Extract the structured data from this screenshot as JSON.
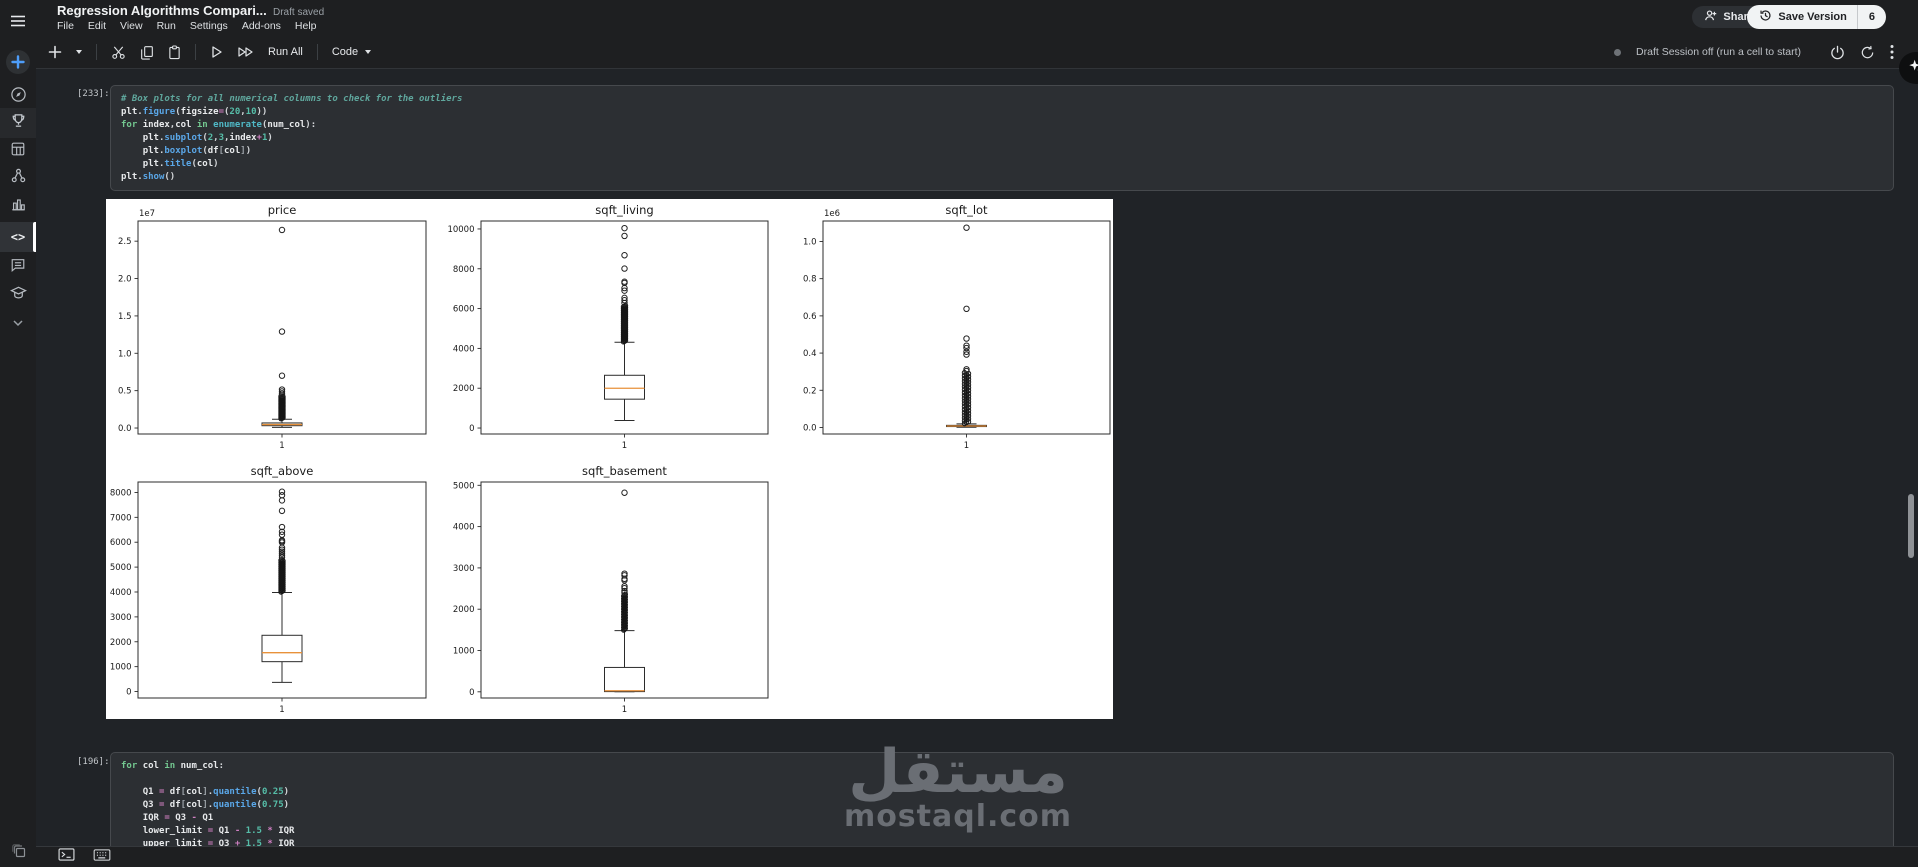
{
  "header": {
    "title": "Regression Algorithms Compari...",
    "draft_status": "Draft saved",
    "menus": [
      "File",
      "Edit",
      "View",
      "Run",
      "Settings",
      "Add-ons",
      "Help"
    ],
    "share_label": "Share",
    "save_version_label": "Save Version",
    "version_count": "6"
  },
  "toolbar": {
    "run_all_label": "Run All",
    "cell_type_label": "Code",
    "session_status": "Draft Session off (run a cell to start)",
    "icons": [
      "add-cell-plus",
      "add-cell-caret-down",
      "cut-scissors",
      "copy-cells",
      "paste-cells",
      "run-cell-play",
      "run-all-fast-forward",
      "power-session",
      "restart-session",
      "more-kebab"
    ]
  },
  "sidebar": {
    "icons": [
      "hamburger-menu",
      "create-plus",
      "home-compass",
      "competitions-trophy",
      "datasets-grid",
      "models-network",
      "benchmarks-chart",
      "code-brackets",
      "discussions-comment",
      "learn-graduation-cap",
      "more-chevron-down"
    ],
    "active": "code-brackets"
  },
  "cells": [
    {
      "exec_label": "[233]:",
      "lines": [
        [
          [
            "# Box plots for all numerical columns to check for the outliers",
            "com"
          ]
        ],
        [
          [
            "plt",
            "id"
          ],
          [
            ".",
            "pun"
          ],
          [
            "figure",
            "fn"
          ],
          [
            "(",
            "pun"
          ],
          [
            "figsize",
            "id"
          ],
          [
            "=",
            "op"
          ],
          [
            "(",
            "pun"
          ],
          [
            "20",
            "num"
          ],
          [
            ",",
            "pun"
          ],
          [
            "10",
            "num"
          ],
          [
            "))",
            "pun"
          ]
        ],
        [
          [
            "for",
            "kw"
          ],
          [
            " ",
            "pun"
          ],
          [
            "index",
            "id"
          ],
          [
            ",",
            "pun"
          ],
          [
            "col",
            "id"
          ],
          [
            " ",
            "pun"
          ],
          [
            "in",
            "kw"
          ],
          [
            " ",
            "pun"
          ],
          [
            "enumerate",
            "bi"
          ],
          [
            "(",
            "pun"
          ],
          [
            "num_col",
            "id"
          ],
          [
            "):",
            "pun"
          ]
        ],
        [
          [
            "    ",
            "pun"
          ],
          [
            "plt",
            "id"
          ],
          [
            ".",
            "pun"
          ],
          [
            "subplot",
            "fn"
          ],
          [
            "(",
            "pun"
          ],
          [
            "2",
            "num"
          ],
          [
            ",",
            "pun"
          ],
          [
            "3",
            "num"
          ],
          [
            ",",
            "pun"
          ],
          [
            "index",
            "id"
          ],
          [
            "+",
            "op"
          ],
          [
            "1",
            "num"
          ],
          [
            ")",
            "pun"
          ]
        ],
        [
          [
            "    ",
            "pun"
          ],
          [
            "plt",
            "id"
          ],
          [
            ".",
            "pun"
          ],
          [
            "boxplot",
            "fn"
          ],
          [
            "(",
            "pun"
          ],
          [
            "df",
            "id"
          ],
          [
            "[",
            "br"
          ],
          [
            "col",
            "id"
          ],
          [
            "]",
            "br"
          ],
          [
            ")",
            "pun"
          ]
        ],
        [
          [
            "    ",
            "pun"
          ],
          [
            "plt",
            "id"
          ],
          [
            ".",
            "pun"
          ],
          [
            "title",
            "fn"
          ],
          [
            "(",
            "pun"
          ],
          [
            "col",
            "id"
          ],
          [
            ")",
            "pun"
          ]
        ],
        [
          [
            "plt",
            "id"
          ],
          [
            ".",
            "pun"
          ],
          [
            "show",
            "fn"
          ],
          [
            "()",
            "pun"
          ]
        ]
      ]
    },
    {
      "exec_label": "[196]:",
      "lines": [
        [
          [
            "for",
            "kw"
          ],
          [
            " ",
            "pun"
          ],
          [
            "col",
            "id"
          ],
          [
            " ",
            "pun"
          ],
          [
            "in",
            "kw"
          ],
          [
            " ",
            "pun"
          ],
          [
            "num_col",
            "id"
          ],
          [
            ":",
            "pun"
          ]
        ],
        [
          [
            " ",
            "pun"
          ]
        ],
        [
          [
            "    ",
            "pun"
          ],
          [
            "Q1",
            "id"
          ],
          [
            " ",
            "pun"
          ],
          [
            "=",
            "op"
          ],
          [
            " ",
            "pun"
          ],
          [
            "df",
            "id"
          ],
          [
            "[",
            "br"
          ],
          [
            "col",
            "id"
          ],
          [
            "]",
            "br"
          ],
          [
            ".",
            "pun"
          ],
          [
            "quantile",
            "fn"
          ],
          [
            "(",
            "pun"
          ],
          [
            "0.25",
            "num"
          ],
          [
            ")",
            "pun"
          ]
        ],
        [
          [
            "    ",
            "pun"
          ],
          [
            "Q3",
            "id"
          ],
          [
            " ",
            "pun"
          ],
          [
            "=",
            "op"
          ],
          [
            " ",
            "pun"
          ],
          [
            "df",
            "id"
          ],
          [
            "[",
            "br"
          ],
          [
            "col",
            "id"
          ],
          [
            "]",
            "br"
          ],
          [
            ".",
            "pun"
          ],
          [
            "quantile",
            "fn"
          ],
          [
            "(",
            "pun"
          ],
          [
            "0.75",
            "num"
          ],
          [
            ")",
            "pun"
          ]
        ],
        [
          [
            "    ",
            "pun"
          ],
          [
            "IQR",
            "id"
          ],
          [
            " ",
            "pun"
          ],
          [
            "=",
            "op"
          ],
          [
            " ",
            "pun"
          ],
          [
            "Q3",
            "id"
          ],
          [
            " ",
            "pun"
          ],
          [
            "-",
            "op"
          ],
          [
            " ",
            "pun"
          ],
          [
            "Q1",
            "id"
          ]
        ],
        [
          [
            "    ",
            "pun"
          ],
          [
            "lower_limit",
            "id"
          ],
          [
            " ",
            "pun"
          ],
          [
            "=",
            "op"
          ],
          [
            " ",
            "pun"
          ],
          [
            "Q1",
            "id"
          ],
          [
            " ",
            "pun"
          ],
          [
            "-",
            "op"
          ],
          [
            " ",
            "pun"
          ],
          [
            "1.5",
            "num"
          ],
          [
            " ",
            "pun"
          ],
          [
            "*",
            "op"
          ],
          [
            " ",
            "pun"
          ],
          [
            "IQR",
            "id"
          ]
        ],
        [
          [
            "    ",
            "pun"
          ],
          [
            "upper_limit",
            "id"
          ],
          [
            " ",
            "pun"
          ],
          [
            "=",
            "op"
          ],
          [
            " ",
            "pun"
          ],
          [
            "Q3",
            "id"
          ],
          [
            " ",
            "pun"
          ],
          [
            "+",
            "op"
          ],
          [
            " ",
            "pun"
          ],
          [
            "1.5",
            "num"
          ],
          [
            " ",
            "pun"
          ],
          [
            "*",
            "op"
          ],
          [
            " ",
            "pun"
          ],
          [
            "IQR",
            "id"
          ]
        ]
      ]
    }
  ],
  "chart_data": [
    {
      "type": "boxplot",
      "title": "price",
      "scale_label": "1e7",
      "xtick_label": "1",
      "ylim": [
        -0.08,
        2.77
      ],
      "yticks": [
        0.0,
        0.5,
        1.0,
        1.5,
        2.0,
        2.5
      ],
      "ytick_labels": [
        "0.0",
        "0.5",
        "1.0",
        "1.5",
        "2.0",
        "2.5"
      ],
      "box": {
        "q1": 0.031,
        "median": 0.046,
        "q3": 0.068,
        "whisker_low": 0.008,
        "whisker_high": 0.117
      },
      "dense_outliers": {
        "from": 0.125,
        "to": 0.43,
        "count": 50
      },
      "outliers": [
        0.445,
        0.465,
        0.49,
        0.515,
        0.7,
        1.29,
        2.65
      ],
      "layout": {
        "rect": [
          32,
          22,
          288,
          213
        ],
        "box_width": 40,
        "flier_col_width": 6
      }
    },
    {
      "type": "boxplot",
      "title": "sqft_living",
      "scale_label": "",
      "xtick_label": "1",
      "ylim": [
        -300,
        10400
      ],
      "yticks": [
        0,
        2000,
        4000,
        6000,
        8000,
        10000
      ],
      "ytick_labels": [
        "0",
        "2000",
        "4000",
        "6000",
        "8000",
        "10000"
      ],
      "box": {
        "q1": 1450,
        "median": 2000,
        "q3": 2650,
        "whisker_low": 380,
        "whisker_high": 4310
      },
      "dense_outliers": {
        "from": 4330,
        "to": 6150,
        "count": 60
      },
      "outliers": [
        6280,
        6420,
        6540,
        6900,
        7030,
        7290,
        7350,
        8010,
        8680,
        9650,
        10040
      ],
      "layout": {
        "rect": [
          375,
          22,
          287,
          213
        ],
        "box_width": 40,
        "flier_col_width": 6
      }
    },
    {
      "type": "boxplot",
      "title": "sqft_lot",
      "scale_label": "1e6",
      "xtick_label": "1",
      "ylim": [
        -0.035,
        1.11
      ],
      "yticks": [
        0.0,
        0.2,
        0.4,
        0.6,
        0.8,
        1.0
      ],
      "ytick_labels": [
        "0.0",
        "0.2",
        "0.4",
        "0.6",
        "0.8",
        "1.0"
      ],
      "box": {
        "q1": 0.005,
        "median": 0.008,
        "q3": 0.0115,
        "whisker_low": 0.001,
        "whisker_high": 0.0195
      },
      "dense_outliers": {
        "from": 0.021,
        "to": 0.295,
        "count": 55
      },
      "outliers": [
        0.303,
        0.313,
        0.392,
        0.407,
        0.427,
        0.44,
        0.478,
        0.638,
        1.074
      ],
      "layout": {
        "rect": [
          717,
          22,
          287,
          213
        ],
        "box_width": 40,
        "flier_col_width": 8
      }
    },
    {
      "type": "boxplot",
      "title": "sqft_above",
      "scale_label": "",
      "xtick_label": "1",
      "ylim": [
        -260,
        8420
      ],
      "yticks": [
        0,
        1000,
        2000,
        3000,
        4000,
        5000,
        6000,
        7000,
        8000
      ],
      "ytick_labels": [
        "0",
        "1000",
        "2000",
        "3000",
        "4000",
        "5000",
        "6000",
        "7000",
        "8000"
      ],
      "box": {
        "q1": 1200,
        "median": 1560,
        "q3": 2260,
        "whisker_low": 370,
        "whisker_high": 3980
      },
      "dense_outliers": {
        "from": 4000,
        "to": 5300,
        "count": 50
      },
      "outliers": [
        5390,
        5460,
        5540,
        5620,
        5700,
        5780,
        5990,
        6040,
        6080,
        6300,
        6420,
        6610,
        7260,
        7680,
        7890,
        8030
      ],
      "layout": {
        "rect": [
          32,
          283,
          288,
          216
        ],
        "box_width": 40,
        "flier_col_width": 6
      }
    },
    {
      "type": "boxplot",
      "title": "sqft_basement",
      "scale_label": "",
      "xtick_label": "1",
      "ylim": [
        -150,
        5080
      ],
      "yticks": [
        0,
        1000,
        2000,
        3000,
        4000,
        5000
      ],
      "ytick_labels": [
        "0",
        "1000",
        "2000",
        "3000",
        "4000",
        "5000"
      ],
      "box": {
        "q1": 5,
        "median": 25,
        "q3": 590,
        "whisker_low": 0,
        "whisker_high": 1480
      },
      "dense_outliers": {
        "from": 1495,
        "to": 2360,
        "count": 42
      },
      "outliers": [
        2400,
        2440,
        2510,
        2555,
        2700,
        2735,
        2820,
        2860,
        4820
      ],
      "layout": {
        "rect": [
          375,
          283,
          287,
          216
        ],
        "box_width": 40,
        "flier_col_width": 5
      }
    }
  ],
  "watermark": {
    "arabic": "مستقل",
    "domain": "mostaql.com"
  },
  "statusbar": {
    "icons": [
      "stacked-windows",
      "terminal-console",
      "keyboard"
    ]
  },
  "colors": {
    "background": "#1e1f21",
    "panel": "#2c2f33",
    "accent_blue": "#4e9df8",
    "median_orange": "#e8913a",
    "save_button_bg": "#f1f3f4",
    "watermark_gray": "#6a6e74"
  }
}
